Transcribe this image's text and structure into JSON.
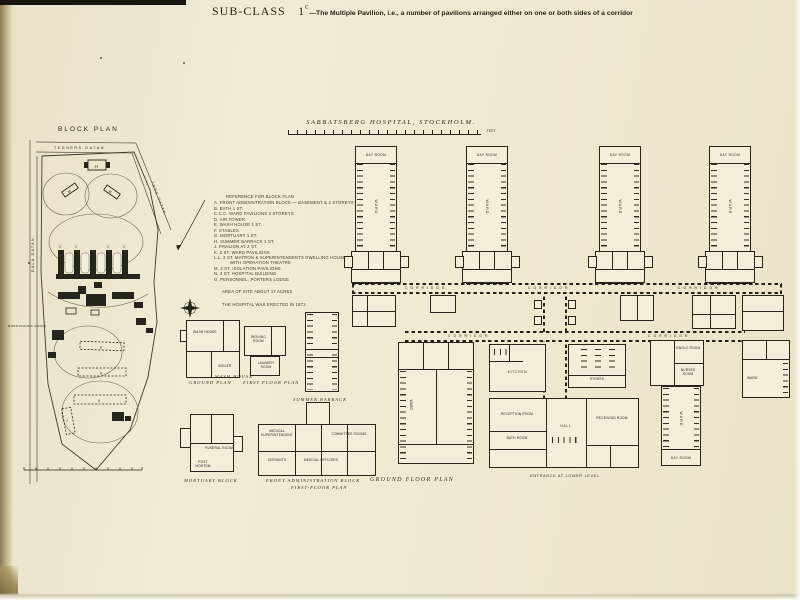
{
  "page": {
    "subclass": "SUB-CLASS",
    "subclass_num": "1",
    "subclass_sup": "c",
    "title_rest": "—The Multiple Pavilion, i.e., a number of pavilions arranged either on one or both sides of a corridor"
  },
  "block_plan": {
    "title": "BLOCK PLAN",
    "street_top": "TEGNERS GATAN",
    "street_right": "TORS GATAN",
    "street_left": "DALA GATAN",
    "street_left_lower": "RORSTRANDS GATAN",
    "letters": {
      "a": "A",
      "b": "B",
      "c": "C",
      "d": "D",
      "e": "E",
      "f": "F",
      "g": "G",
      "h": "H",
      "j": "J",
      "k": "K",
      "m": "M",
      "n": "N",
      "o": "O"
    }
  },
  "legend": {
    "lines": [
      "REFERENCE FOR BLOCK PLAN",
      "A. FRONT ADMINISTRATION BLOCK — BASEMENT & 2 STOREYS",
      "B. BATH  1 ST.",
      "C.C.C. WARD PAVILIONS  2 STOREYS",
      "D. AIR TOWER",
      "E. WASH HOUSE  1 ST.",
      "F. STABLES",
      "G. MORTUARY  1 ST.",
      "H. SUMMER BARRACK  1 ST.",
      "J. PAVILION AT  2 ST.",
      "K. 2 ST. WARD PAVILIONS",
      "L.L. 2 ST. MATRON & SUPERINTENDENTS DWELLING HOUSE",
      "WITH OPERATION THEATRE",
      "M. 2 ST. ISOLATION PAVILIONS",
      "N. 2 ST. HOSPITAL BUILDING",
      "O. PERSONNEL, PORTERS LODGE",
      "AREA OF SITE ABOUT 17 ACRES",
      "THE HOSPITAL WAS ERECTED IN 1872"
    ]
  },
  "main_plan": {
    "title": "SABBATSBERG HOSPITAL, STOCKHOLM.",
    "corridor_label": "CORRIDOR",
    "caption": "GROUND FLOOR PLAN",
    "entrance_note": "ENTRANCE AT LOWER LEVEL",
    "scale_feet": "FEET",
    "rooms": {
      "day_room": "DAY ROOM",
      "ward": "WARD",
      "hall": "HALL",
      "receiving_room": "RECEIVING ROOM",
      "kitchen": "KITCHEN",
      "stores": "STORES",
      "single_room": "SINGLE ROOM",
      "nurses_room": "NURSES ROOM",
      "bath_room": "BATH ROOM",
      "reception_room": "RECEPTION ROOM"
    }
  },
  "small_plans": {
    "ground_plan_caption": "GROUND PLAN",
    "wash_house_label": "WASH HOUSE",
    "first_floor_caption": "FIRST FLOOR PLAN",
    "summer_barrack_caption": "SUMMER BARRACK",
    "mortuary_caption": "MORTUARY BLOCK",
    "admin_caption_1": "FRONT ADMINISTRATION BLOCK",
    "admin_caption_2": "FIRST-FLOOR PLAN",
    "rooms": {
      "wash_house": "WASH HOUSE",
      "boiler": "BOILER",
      "laundry_room": "LAUNDRY ROOM",
      "ironing_room": "IRONING ROOM",
      "funeral_room": "FUNERAL ROOM",
      "post_mortem": "POST MORTEM",
      "committee_rooms": "COMMITTEE ROOMS",
      "medical_supt": "MEDICAL SUPERINTENDENT",
      "servants": "SERVANTS",
      "medical_officers": "MEDICAL OFFICERS"
    }
  }
}
